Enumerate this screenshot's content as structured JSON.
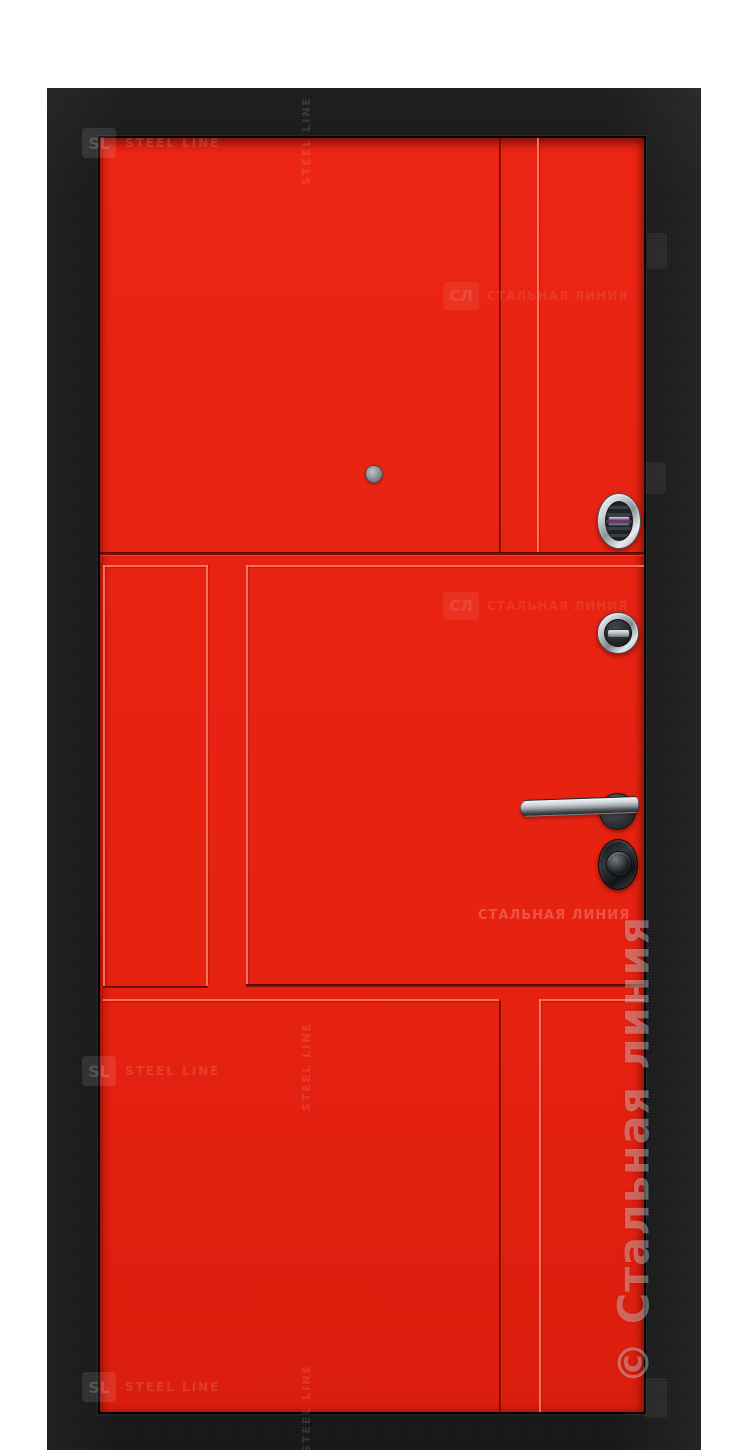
{
  "colors": {
    "frame": "#161616",
    "panel": "#e8240f",
    "groove_dark": "#4a0600",
    "groove_light": "#ff8068",
    "chrome_light": "#f2f4f6",
    "chrome_dark": "#55595e",
    "watermark_white": "#ffffff"
  },
  "watermarks": {
    "copyright": "© Стальная линия",
    "sl": "SL",
    "steel_line": "STEEL LINE",
    "brand_ru": "СТАЛЬНАЯ ЛИНИЯ",
    "monogram": "СЛ"
  }
}
